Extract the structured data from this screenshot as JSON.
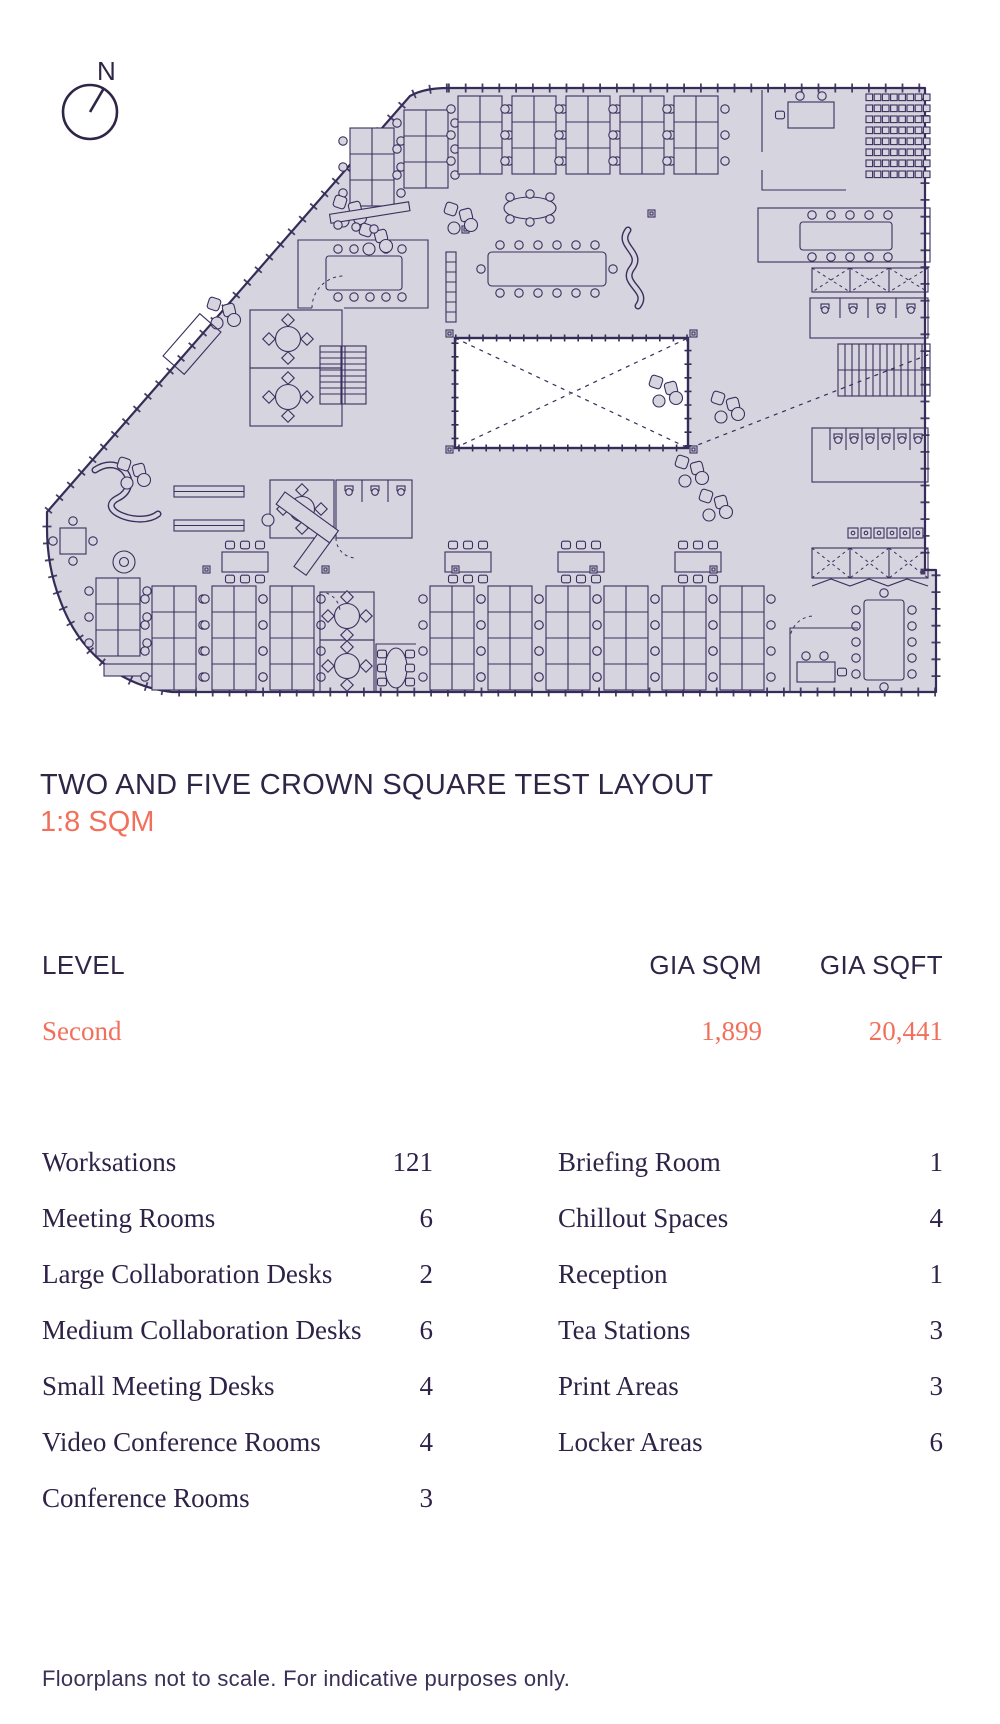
{
  "page": {
    "compass_label": "N",
    "title": "TWO AND FIVE CROWN SQUARE TEST LAYOUT",
    "subtitle": "1:8 SQM",
    "footnote": "Floorplans not to scale. For indicative purposes only."
  },
  "colors": {
    "accent": "#F2705B",
    "ink": "#2F2547",
    "plan_fill": "#D6D4DE",
    "plan_line": "#3A2F5E"
  },
  "area_table": {
    "columns": {
      "level": "LEVEL",
      "sqm": "GIA SQM",
      "sqft": "GIA SQFT"
    },
    "rows": [
      {
        "level": "Second",
        "gia_sqm": "1,899",
        "gia_sqft": "20,441"
      }
    ]
  },
  "amenities": {
    "left": [
      {
        "label": "Worksations",
        "value": "121"
      },
      {
        "label": "Meeting Rooms",
        "value": "6"
      },
      {
        "label": "Large Collaboration Desks",
        "value": "2"
      },
      {
        "label": "Medium Collaboration Desks",
        "value": "6"
      },
      {
        "label": "Small Meeting Desks",
        "value": "4"
      },
      {
        "label": "Video Conference Rooms",
        "value": "4"
      },
      {
        "label": "Conference Rooms",
        "value": "3"
      }
    ],
    "right": [
      {
        "label": "Briefing Room",
        "value": "1"
      },
      {
        "label": "Chillout Spaces",
        "value": "4"
      },
      {
        "label": "Reception",
        "value": "1"
      },
      {
        "label": "Tea Stations",
        "value": "3"
      },
      {
        "label": "Print Areas",
        "value": "3"
      },
      {
        "label": "Locker Areas",
        "value": "6"
      }
    ]
  }
}
